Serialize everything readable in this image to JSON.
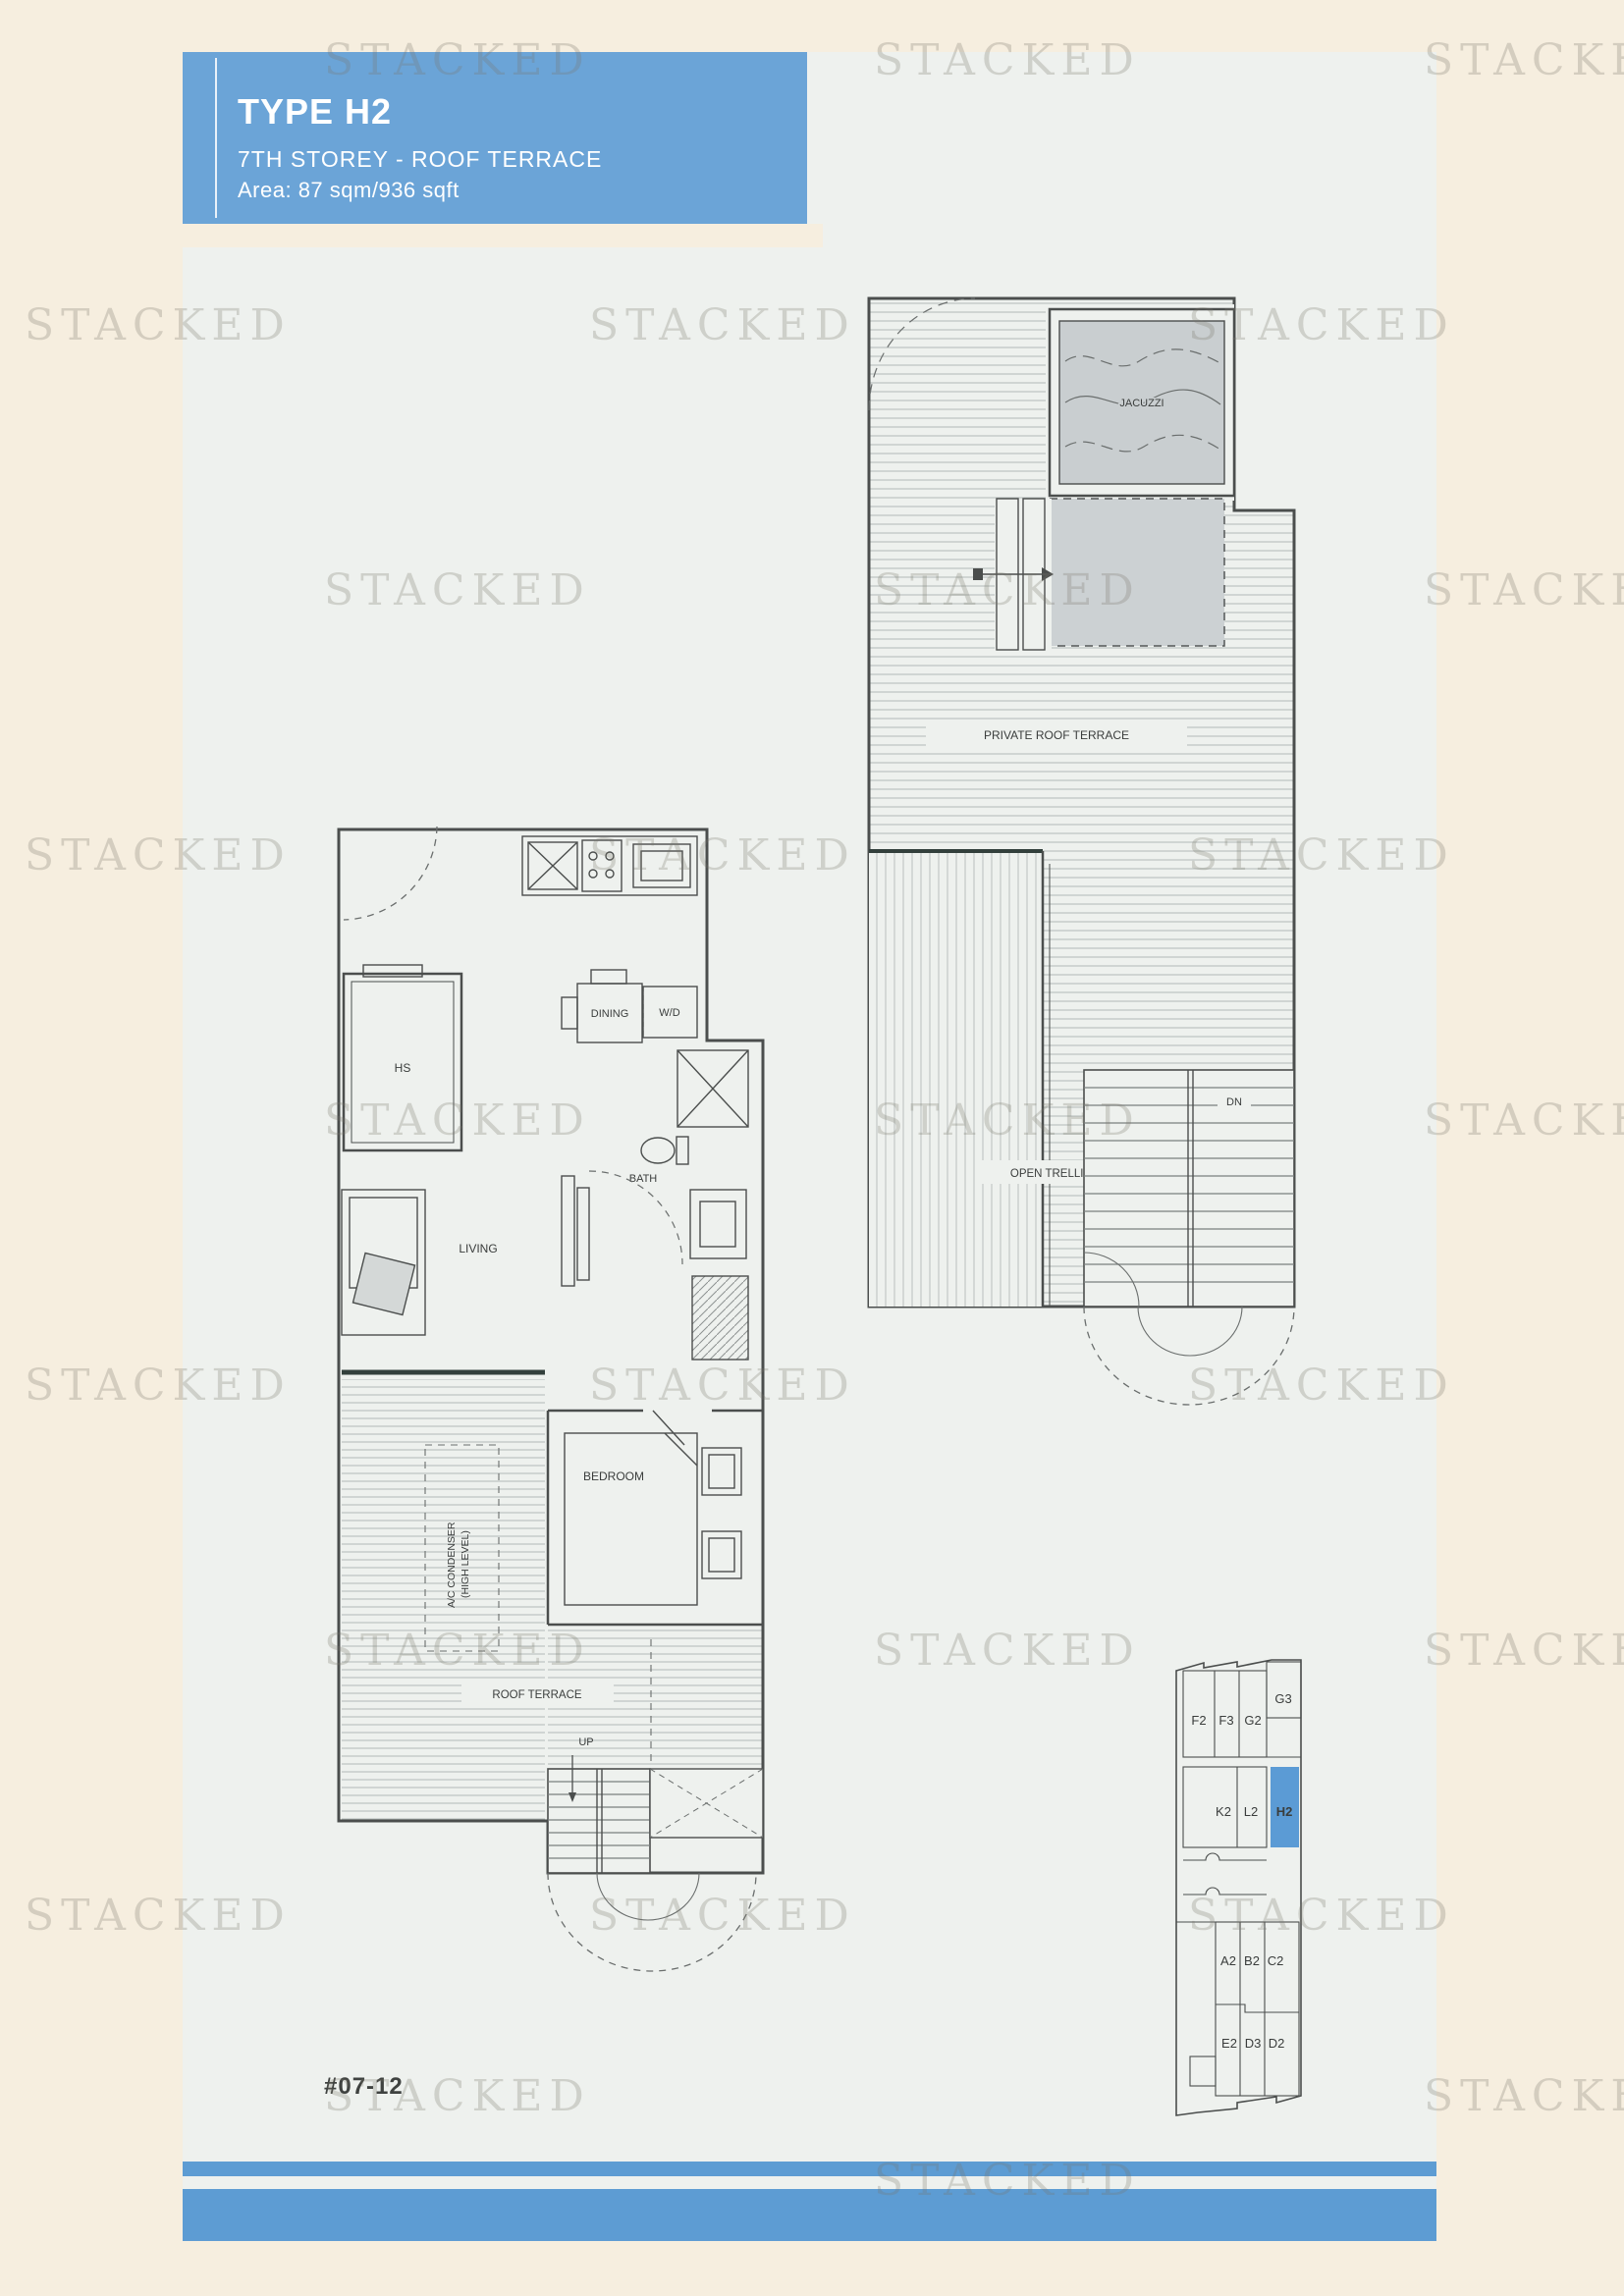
{
  "watermark": {
    "text": "STACKED"
  },
  "header": {
    "title": "TYPE H2",
    "subtitle": "7TH STOREY - ROOF TERRACE",
    "area": "Area: 87 sqm/936 sqft"
  },
  "unit_number": "#07-12",
  "colors": {
    "header_blue": "#6ba4d7",
    "band_blue": "#5d9cd3",
    "highlight_blue": "#5b9bd5",
    "panel_white": "#eef1ee",
    "background_beige": "#f6eedf"
  },
  "plans": {
    "lower": {
      "labels": {
        "hs": "HS",
        "dining": "DINING",
        "wd": "W/D",
        "bath": "BATH",
        "living": "LIVING",
        "bedroom": "BEDROOM",
        "ac_line1": "A/C CONDENSER",
        "ac_line2": "(HIGH LEVEL)",
        "roof_terrace": "ROOF TERRACE",
        "up": "UP"
      }
    },
    "upper": {
      "labels": {
        "jacuzzi": "JACUZZI",
        "private_roof_terrace": "PRIVATE ROOF TERRACE",
        "open_trellis": "OPEN TRELLIS",
        "dn": "DN"
      }
    }
  },
  "locator": {
    "units": {
      "f2": "F2",
      "f3": "F3",
      "g2": "G2",
      "g3": "G3",
      "k2": "K2",
      "l2": "L2",
      "h2_highlight": "H2",
      "a2": "A2",
      "b2": "B2",
      "c2": "C2",
      "e2": "E2",
      "d3": "D3",
      "d2": "D2"
    }
  }
}
